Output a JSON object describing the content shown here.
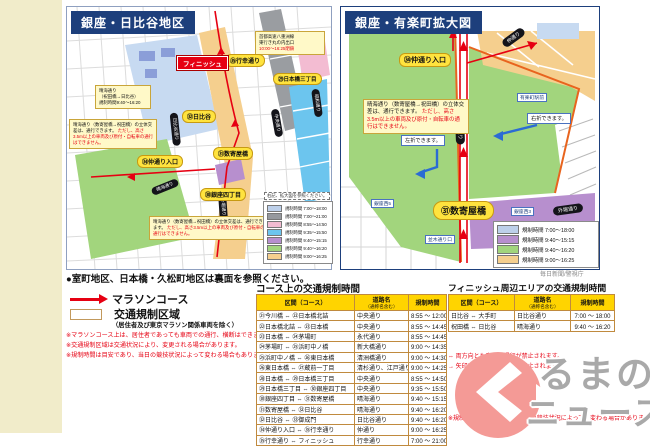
{
  "page": {
    "credit": "毎日新聞/警視庁"
  },
  "maps": {
    "left": {
      "title": "銀座・日比谷地区",
      "finish_label": "フィニッシュ",
      "callouts": {
        "gyoko": "㉟行幸通り",
        "nihonbashi3": "㉙日本橋三丁目",
        "hibiya": "㉜日比谷",
        "nakadori": "㉞仲通り入口",
        "sukiyabashi": "㉛数寄屋橋",
        "ginza4": "㉚銀座四丁目"
      },
      "pills": {
        "hibiya_dori": "日比谷通り",
        "harumi_dori": "晴海通り",
        "chuo_dori": "中央通り",
        "showa_dori": "昭和通り",
        "sotobori_dori": "外堀通り"
      },
      "small_labels": {
        "iwaidabashi": "祝田橋"
      },
      "notes": {
        "expressway": [
          "首都高速八重洲線",
          "東行き丸の内出口",
          "10:00〜16:25閉鎖"
        ],
        "harumi": [
          "晴海通り",
          "（祝田橋→日比谷）",
          "規制時間9:40〜16:20"
        ],
        "grade_black": "晴海通り（数寄屋橋→祝田橋）の立体交差は、通行できます。",
        "grade_red": "ただし、高さ3.5m以上の車両及び原付・自転車の通行はできません。"
      },
      "legend_note": "右記、拡大図を参照ください。",
      "legend": [
        {
          "color": "#bdd0ea",
          "label": "規制時間 7:00〜18:00"
        },
        {
          "color": "#96999e",
          "label": "規制時間 7:00〜21:00"
        },
        {
          "color": "#f3bcd2",
          "label": "規制時間 8:55〜14:50"
        },
        {
          "color": "#6cc5ee",
          "label": "規制時間 9:35〜15:50"
        },
        {
          "color": "#b78fce",
          "label": "規制時間 9:40〜15:15"
        },
        {
          "color": "#a2d57d",
          "label": "規制時間 9:40〜16:20"
        },
        {
          "color": "#f5cf8e",
          "label": "規制時間 9:00〜16:25"
        }
      ]
    },
    "right": {
      "title": "銀座・有楽町拡大図",
      "callouts": {
        "nakadori": "㉞仲通り入口",
        "sukiyabashi": "㉛数寄屋橋"
      },
      "pills": {
        "nakadori": "仲通り",
        "sotobori_v": "外堀通り",
        "sotobori": "外堀通り"
      },
      "small_labels": {
        "yurakucho": "有楽町駅前",
        "ginzaw5": "銀座西5",
        "ginzaw3": "銀座西3",
        "namiki": "並木通り口"
      },
      "turn_notes": {
        "right": "右折できます。",
        "left": "左折できます。"
      },
      "note_black": "晴海通り（数寄屋橋→祝田橋）の立体交差は、通行できます。",
      "note_red": "ただし、高さ3.5m以上の車両及び原付・自転車の通行はできません。",
      "legend": [
        {
          "color": "#bdd0ea",
          "label": "規制時間 7:00〜18:00"
        },
        {
          "color": "#b78fce",
          "label": "規制時間 9:40〜15:15"
        },
        {
          "color": "#a2d57d",
          "label": "規制時間 9:40〜16:20"
        },
        {
          "color": "#f5cf8e",
          "label": "規制時間 9:00〜16:25"
        }
      ]
    }
  },
  "bottom": {
    "backside_note": "●室町地区、日本橋・久松町地区は裏面を参照ください。",
    "course_key": {
      "arrow": "マラソンコース",
      "zone": "交通規制区域",
      "zone_sub": "（居住者及び東京マラソン関係車両を除く）"
    },
    "warnings": [
      "※マラソンコース上は、居住者であっても車両での通行、横断はできません。",
      "※交通規制区域は交通状況により、変更される場合があります。",
      "※規制時間は目安であり、当日の競技状況によって変わる場合もあります。"
    ],
    "course_table": {
      "title": "コース上の交通規制時間",
      "headers": {
        "section": "区間（コース）",
        "road": "道路名",
        "road_sub": "（通称名含む）",
        "time": "規制時間"
      },
      "rows": [
        {
          "section": "㉑今川橋 ⇔ ㉒日本橋北詰",
          "road": "中央通り",
          "time": "8:55 〜 12:00"
        },
        {
          "section": "㉒日本橋北詰 ⇔ ㉓日本橋",
          "road": "中央通り",
          "time": "8:55 〜 14:45"
        },
        {
          "section": "㉓日本橋 ⇔ ㉔茅場町",
          "road": "永代通り",
          "time": "8:55 〜 14:45"
        },
        {
          "section": "㉔茅場町 ⇔ ㉕浜町中ノ橋",
          "road": "新大橋通り",
          "time": "9:00 〜 14:35"
        },
        {
          "section": "㉕浜町中ノ橋 ⇔ ㉖東日本橋",
          "road": "清洲橋通り",
          "time": "9:00 〜 14:30"
        },
        {
          "section": "㉖東日本橋 ⇔ ㉗蔵前一丁目",
          "road": "清杉通り、江戸通り",
          "time": "9:00 〜 14:25"
        },
        {
          "section": "㉘日本橋 ⇔ ㉙日本橋三丁目",
          "road": "中央通り",
          "time": "8:55 〜 14:50"
        },
        {
          "section": "㉙日本橋三丁目 ⇔ ㉚銀座四丁目",
          "road": "中央通り",
          "time": "9:35 〜 15:50"
        },
        {
          "section": "㉚銀座四丁目 ⇔ ㉛数寄屋橋",
          "road": "晴海通り",
          "time": "9:40 〜 15:15"
        },
        {
          "section": "㉛数寄屋橋 ⇔ ㉜日比谷",
          "road": "晴海通り",
          "time": "9:40 〜 16:20"
        },
        {
          "section": "㉜日比谷 ⇔ ㉝御成門",
          "road": "日比谷通り",
          "time": "9:40 〜 16:20"
        },
        {
          "section": "㉞仲通り入口 ⇔ ㉟行幸通り",
          "road": "仲通り",
          "time": "9:00 〜 16:25"
        },
        {
          "section": "㉟行幸通り ⇔ フィニッシュ",
          "road": "行幸通り",
          "time": "7:00 〜 21:00"
        }
      ]
    },
    "finish_table": {
      "title": "フィニッシュ周辺エリアの交通規制時間",
      "headers": {
        "section": "区間（コース）",
        "road": "道路名",
        "road_sub": "（通称名含む）",
        "time": "規制時間"
      },
      "rows": [
        {
          "section": "日比谷 ⇔ 大手町",
          "road": "日比谷通り",
          "time": "7:00 〜 18:00"
        },
        {
          "section": "祝田橋 ⇔ 日比谷",
          "road": "晴海通り",
          "time": "9:40 〜 16:20"
        }
      ]
    },
    "side_notes": [
      "⇔ 両方向とも車両の通行が禁止されます。",
      "→ 矢印方向の車両の通行が禁止されます。",
      "※規制時間は目安であり、当日の競技状況によって、変わる場合があります。"
    ]
  },
  "logo": {
    "line1": "るまの",
    "line2": "ニュース"
  }
}
